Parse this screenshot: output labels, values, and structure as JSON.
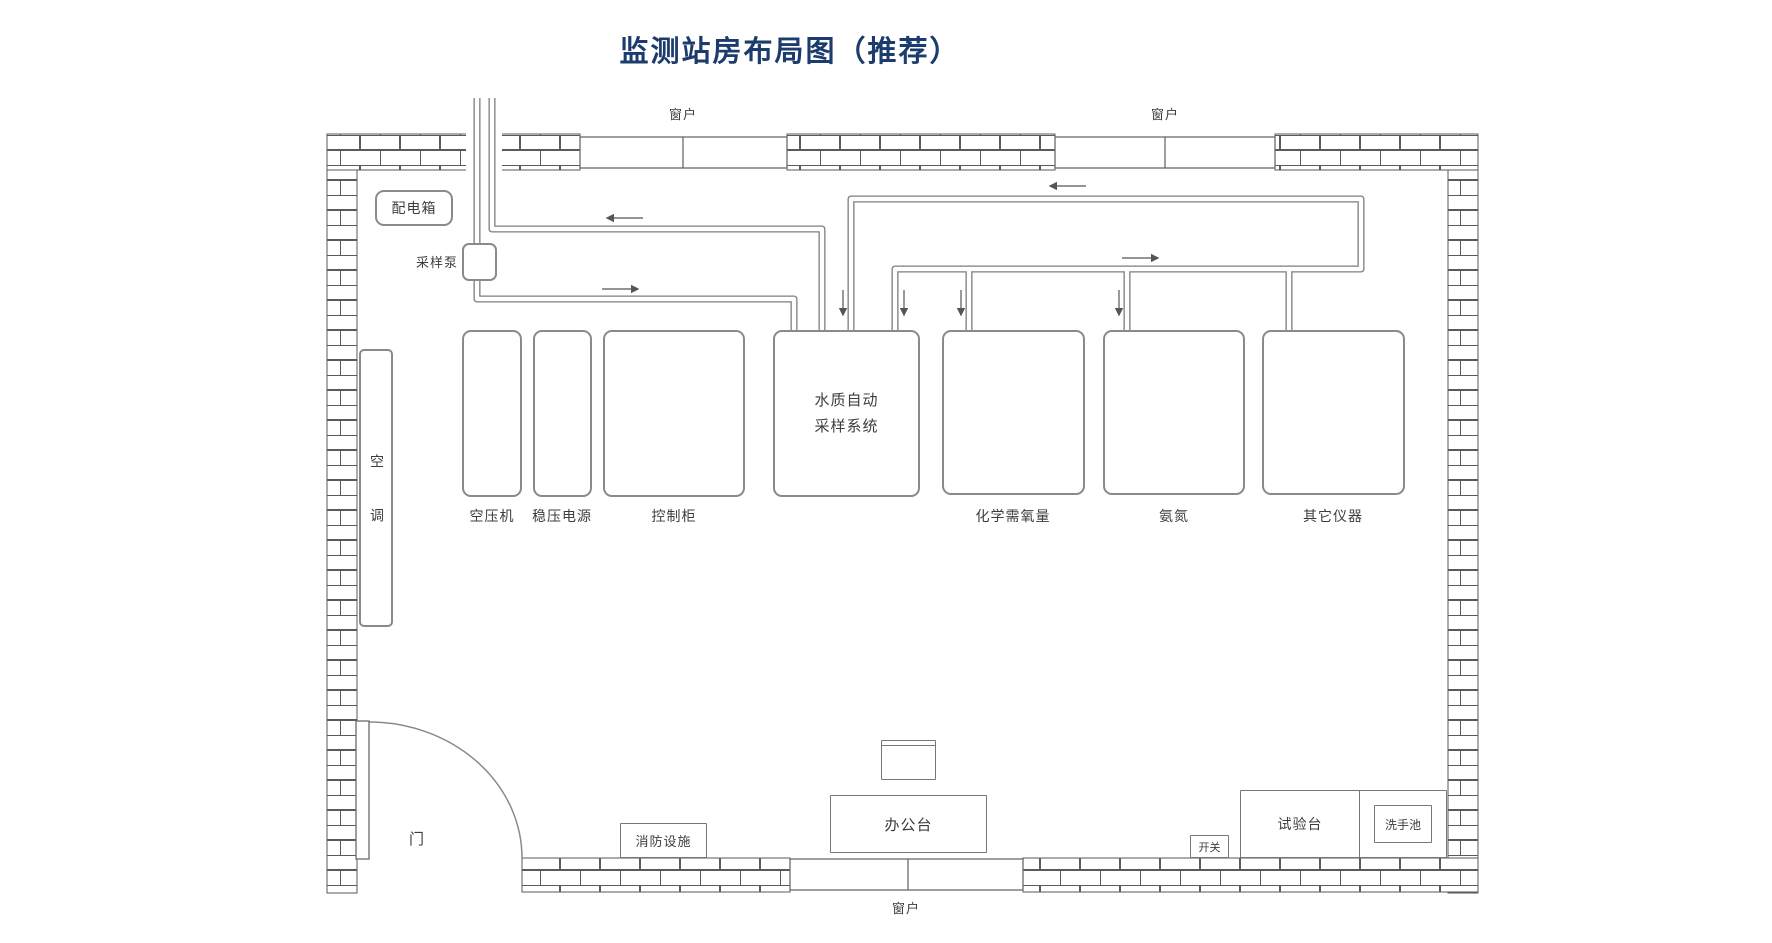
{
  "title": "监测站房布局图（推荐）",
  "colors": {
    "title": "#1C3C6E",
    "wall_line": "#5a5a5a",
    "pipe_line": "#7d7d7d",
    "box_line": "#8a8a8a"
  },
  "windows": {
    "top_left": "窗户",
    "top_right": "窗户",
    "bottom": "窗户"
  },
  "door": {
    "label": "门"
  },
  "equipment": {
    "distribution_box": "配电箱",
    "sampling_pump": "采样泵",
    "air_conditioner": "空调",
    "air_compressor": "空压机",
    "voltage_stabilizer": "稳压电源",
    "control_cabinet": "控制柜",
    "water_sampling_system": "水质自动采样系统",
    "cod_analyzer": "化学需氧量",
    "ammonia_analyzer": "氨氮",
    "other_instruments": "其它仪器",
    "fire_equipment": "消防设施",
    "office_desk": "办公台",
    "switch": "开关",
    "test_bench": "试验台",
    "sink": "洗手池"
  }
}
